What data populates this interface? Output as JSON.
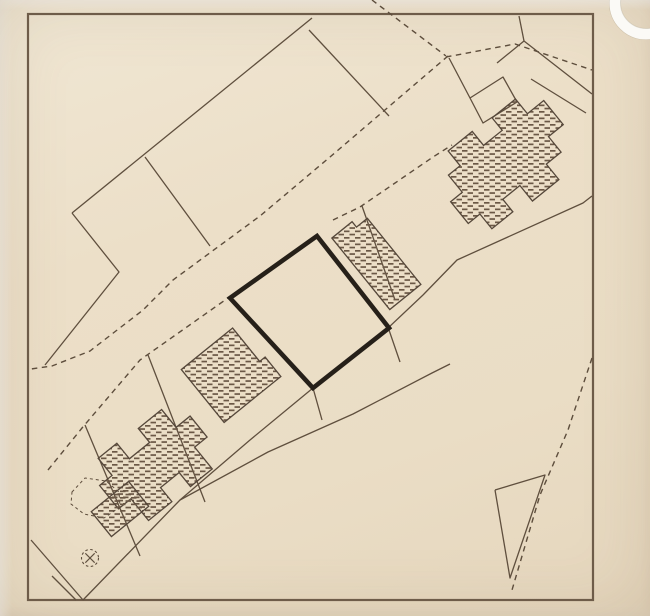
{
  "canvas": {
    "width": 650,
    "height": 616
  },
  "plan": {
    "kind": "scanned cadastral site plan",
    "frame": {
      "x": 28,
      "y": 14,
      "w": 565,
      "h": 586
    },
    "colors": {
      "paper": "#ecdfc8",
      "margin": "#f0e7d4",
      "line": "#5f4f3e",
      "dashed_line": "#5d4d3c",
      "bold_plot": "#262019",
      "hatch": "#6b5846",
      "punch_hole_white": "#fbfaf6",
      "punch_hole_edge": "rgba(160,150,130,0.35)"
    },
    "boundaries_solid": [
      {
        "name": "parcel-boundary-upper-left",
        "points": [
          [
            312,
            18
          ],
          [
            72,
            213
          ]
        ]
      },
      {
        "name": "parcel-boundary-upper-left-bend",
        "points": [
          [
            72,
            213
          ],
          [
            119,
            272
          ],
          [
            45,
            365
          ]
        ]
      },
      {
        "name": "parcel-division-left",
        "points": [
          [
            145,
            157
          ],
          [
            210,
            246
          ]
        ]
      },
      {
        "name": "parcel-division-right",
        "points": [
          [
            309,
            30
          ],
          [
            389,
            116
          ]
        ]
      },
      {
        "name": "top-right-parcel-line-a",
        "points": [
          [
            497,
            63
          ],
          [
            524,
            41
          ],
          [
            592,
            94
          ]
        ]
      },
      {
        "name": "top-right-parcel-line-b",
        "points": [
          [
            524,
            41
          ],
          [
            519,
            16
          ]
        ]
      },
      {
        "name": "top-right-parcel-line-c",
        "points": [
          [
            531,
            79
          ],
          [
            586,
            113
          ]
        ]
      },
      {
        "name": "top-right-sliver-parcel",
        "points": [
          [
            449,
            58
          ],
          [
            470,
            98
          ],
          [
            503,
            77
          ],
          [
            517,
            102
          ],
          [
            483,
            123
          ],
          [
            470,
            98
          ]
        ]
      },
      {
        "name": "street-front-upper",
        "points": [
          [
            592,
            196
          ],
          [
            583,
            203
          ],
          [
            457,
            260
          ],
          [
            423,
            295
          ],
          [
            370,
            345
          ],
          [
            313,
            388
          ],
          [
            250,
            440
          ],
          [
            180,
            500
          ]
        ]
      },
      {
        "name": "street-front-lower",
        "points": [
          [
            83,
            600
          ],
          [
            180,
            500
          ],
          [
            268,
            452
          ],
          [
            353,
            414
          ],
          [
            432,
            373
          ],
          [
            450,
            364
          ]
        ]
      },
      {
        "name": "plot-division-left-of-center",
        "points": [
          [
            148,
            355
          ],
          [
            205,
            502
          ]
        ]
      },
      {
        "name": "plot-division-right-of-slim-building",
        "points": [
          [
            362,
            206
          ],
          [
            395,
            300
          ]
        ]
      },
      {
        "name": "plot-division-lower-left",
        "points": [
          [
            85,
            425
          ],
          [
            140,
            556
          ]
        ]
      },
      {
        "name": "connector-at-plot-right-corner",
        "points": [
          [
            389,
            330
          ],
          [
            400,
            362
          ]
        ]
      },
      {
        "name": "connector-at-plot-bottom-corner",
        "points": [
          [
            313,
            388
          ],
          [
            322,
            420
          ]
        ]
      },
      {
        "name": "bottom-left-line-a",
        "points": [
          [
            31,
            540
          ],
          [
            83,
            600
          ]
        ]
      },
      {
        "name": "bottom-left-line-b",
        "points": [
          [
            52,
            576
          ],
          [
            76,
            600
          ]
        ]
      },
      {
        "name": "bottom-right-triangle-parcel",
        "points": [
          [
            495,
            490
          ],
          [
            545,
            475
          ],
          [
            510,
            578
          ],
          [
            495,
            490
          ]
        ]
      }
    ],
    "roads_dashed": [
      {
        "name": "road-edge-main",
        "points": [
          [
            448,
            56
          ],
          [
            330,
            157
          ],
          [
            260,
            216
          ],
          [
            173,
            280
          ],
          [
            143,
            310
          ],
          [
            90,
            351
          ],
          [
            52,
            366
          ],
          [
            31,
            369
          ]
        ]
      },
      {
        "name": "road-edge-lower",
        "points": [
          [
            48,
            470
          ],
          [
            82,
            428
          ],
          [
            140,
            360
          ],
          [
            228,
            298
          ]
        ]
      },
      {
        "name": "road-edge-lower-continuation",
        "points": [
          [
            333,
            220
          ],
          [
            360,
            207
          ],
          [
            433,
            157
          ],
          [
            452,
            145
          ]
        ]
      },
      {
        "name": "path-fork-left",
        "points": [
          [
            372,
            0
          ],
          [
            446,
            56
          ]
        ]
      },
      {
        "name": "path-fork-right",
        "points": [
          [
            446,
            57
          ],
          [
            515,
            44
          ],
          [
            592,
            70
          ]
        ]
      },
      {
        "name": "boundary-bottom-right-curve",
        "points": [
          [
            592,
            358
          ],
          [
            568,
            430
          ],
          [
            540,
            495
          ],
          [
            512,
            590
          ]
        ]
      }
    ],
    "highlight_plot": {
      "name": "highlighted-plot",
      "points": [
        [
          317,
          236
        ],
        [
          389,
          328
        ],
        [
          313,
          388
        ],
        [
          230,
          298
        ]
      ],
      "stroke_width": 4.6
    },
    "buildings": [
      {
        "name": "building-complex-northeast",
        "translate": [
          506,
          162
        ],
        "rotate": -39,
        "points": [
          [
            -68,
            -4
          ],
          [
            -68,
            24
          ],
          [
            -53,
            24
          ],
          [
            -53,
            43
          ],
          [
            -26,
            43
          ],
          [
            -26,
            27
          ],
          [
            -4,
            27
          ],
          [
            -4,
            47
          ],
          [
            30,
            47
          ],
          [
            30,
            27
          ],
          [
            49,
            27
          ],
          [
            49,
            7
          ],
          [
            68,
            7
          ],
          [
            68,
            -24
          ],
          [
            47,
            -24
          ],
          [
            47,
            -43
          ],
          [
            17,
            -43
          ],
          [
            17,
            -27
          ],
          [
            -7,
            -27
          ],
          [
            -7,
            -45
          ],
          [
            -38,
            -45
          ],
          [
            -38,
            -26
          ],
          [
            -53,
            -26
          ],
          [
            -53,
            -4
          ]
        ]
      },
      {
        "name": "building-slim-east-of-plot",
        "translate": [
          377,
          262
        ],
        "rotate": -39,
        "points": [
          [
            -20,
            -47
          ],
          [
            6,
            -47
          ],
          [
            6,
            -40
          ],
          [
            20,
            -40
          ],
          [
            20,
            45
          ],
          [
            -20,
            45
          ]
        ]
      },
      {
        "name": "building-west-of-plot",
        "translate": [
          229,
          376
        ],
        "rotate": -39,
        "points": [
          [
            -33,
            -35
          ],
          [
            33,
            -35
          ],
          [
            33,
            8
          ],
          [
            40,
            8
          ],
          [
            40,
            33
          ],
          [
            -33,
            33
          ]
        ]
      },
      {
        "name": "building-complex-southwest",
        "translate": [
          156,
          463
        ],
        "rotate": -39,
        "points": [
          [
            -58,
            -18
          ],
          [
            -58,
            12
          ],
          [
            -42,
            12
          ],
          [
            -42,
            40
          ],
          [
            -12,
            40
          ],
          [
            -12,
            22
          ],
          [
            12,
            22
          ],
          [
            12,
            40
          ],
          [
            40,
            40
          ],
          [
            40,
            12
          ],
          [
            56,
            12
          ],
          [
            56,
            -15
          ],
          [
            38,
            -15
          ],
          [
            38,
            -38
          ],
          [
            8,
            -38
          ],
          [
            8,
            -20
          ],
          [
            -18,
            -20
          ],
          [
            -18,
            -40
          ],
          [
            -42,
            -40
          ],
          [
            -42,
            -18
          ]
        ]
      },
      {
        "name": "building-small-southwest",
        "translate": [
          120,
          509
        ],
        "rotate": -39,
        "points": [
          [
            -24,
            -16
          ],
          [
            24,
            -16
          ],
          [
            24,
            16
          ],
          [
            -24,
            16
          ]
        ]
      }
    ],
    "symbols": {
      "tree": {
        "name": "tree-symbol",
        "cx": 90,
        "cy": 558,
        "r": 8.5
      },
      "vegetation": {
        "name": "vegetation-outline",
        "points": [
          [
            72,
            492
          ],
          [
            85,
            478
          ],
          [
            106,
            481
          ],
          [
            119,
            492
          ],
          [
            120,
            507
          ],
          [
            104,
            518
          ],
          [
            84,
            514
          ],
          [
            71,
            504
          ]
        ]
      },
      "punch_hole": {
        "name": "punch-hole",
        "cx": 646,
        "cy": 3,
        "r": 31
      }
    }
  }
}
